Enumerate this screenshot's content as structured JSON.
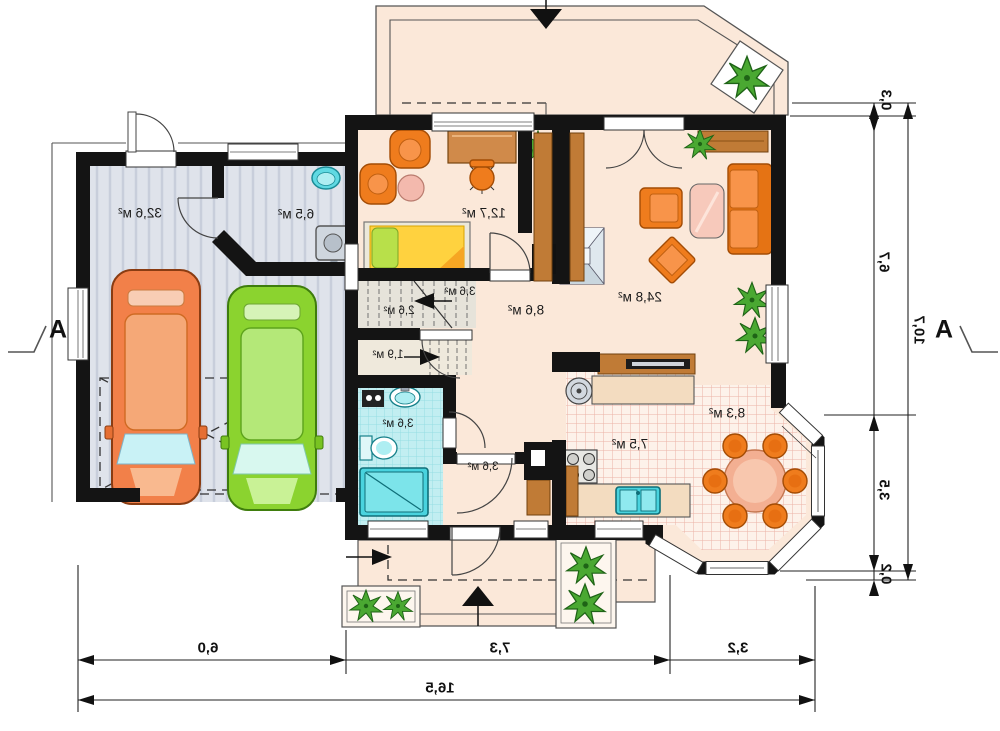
{
  "plan": {
    "title_hint": "mirrored single-storey house floor plan",
    "section_marker": "A",
    "rooms": [
      {
        "id": "garage",
        "area": "32,6 м²"
      },
      {
        "id": "utility",
        "area": "6,5 м²"
      },
      {
        "id": "bedroom",
        "area": "12,7 м²"
      },
      {
        "id": "stair-upper",
        "area": "3,6 м²"
      },
      {
        "id": "stairs",
        "area": "2,6 м²"
      },
      {
        "id": "understairs",
        "area": "1,9 м²"
      },
      {
        "id": "hall",
        "area": "8,6 м²"
      },
      {
        "id": "living-room",
        "area": "24,8 м²"
      },
      {
        "id": "bathroom",
        "area": "3,6 м²"
      },
      {
        "id": "vestibule",
        "area": "3,6 м²"
      },
      {
        "id": "kitchen",
        "area": "7,5 м²"
      },
      {
        "id": "dining",
        "area": "8,3 м²"
      }
    ],
    "dimensions": {
      "bottom": {
        "segments": [
          "6,0",
          "7,3",
          "3,2"
        ],
        "total": "16,5"
      },
      "right": {
        "segments": [
          "0,3",
          "6,7",
          "3,5",
          "0,2"
        ],
        "total": "10,7"
      }
    },
    "colors": {
      "wall": "#141414",
      "floor": "#fbe8d9",
      "garage": "#dfe3eb",
      "garage_stripe": "#c8cedb",
      "wood": "#c07b36",
      "accent_orange": "#ef7c1d",
      "bath_tile": "#c2eef1",
      "fixture_cyan": "#49d3de",
      "tile_bg": "#fdf2ea",
      "tile_line": "#ecb3a6",
      "plant": "#4aa832",
      "car_orange": "#f28049",
      "car_green": "#8bd32f"
    }
  }
}
